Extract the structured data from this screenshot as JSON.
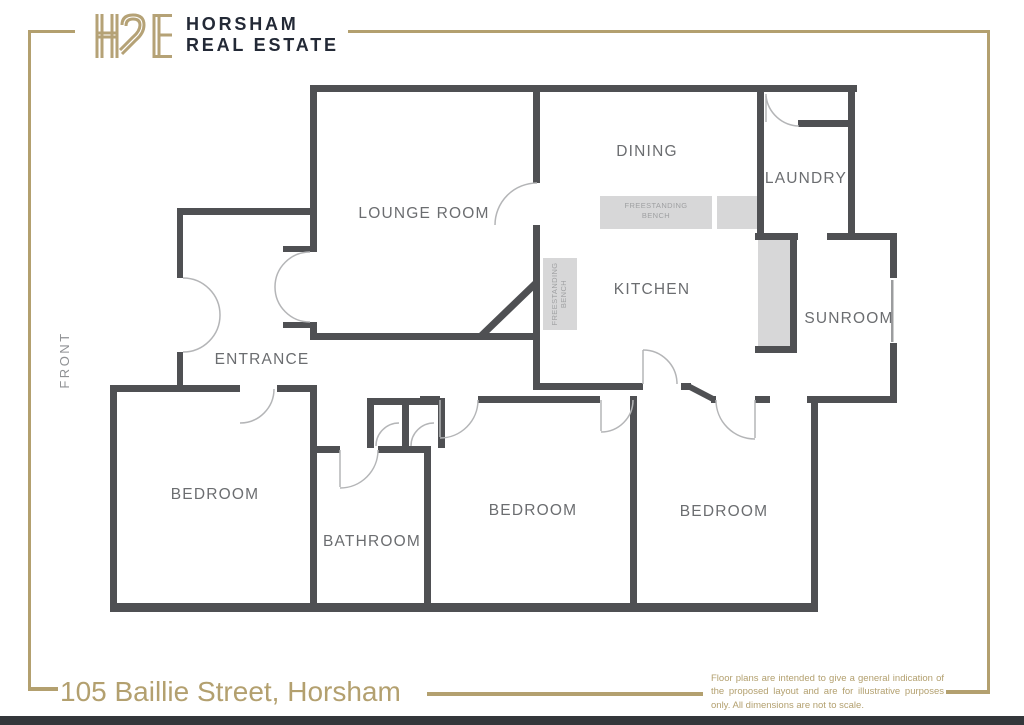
{
  "brand": {
    "monogram": "HRE",
    "name_line1": "HORSHAM",
    "name_line2": "REAL ESTATE"
  },
  "floorplan": {
    "front_label": "FRONT",
    "labels": {
      "lounge": "LOUNGE ROOM",
      "dining": "DINING",
      "laundry": "LAUNDRY",
      "kitchen": "KITCHEN",
      "sunroom": "SUNROOM",
      "entrance": "ENTRANCE",
      "bedroom1": "BEDROOM",
      "bathroom": "BATHROOM",
      "bedroom2": "BEDROOM",
      "bedroom3": "BEDROOM"
    },
    "fixtures": {
      "bench_line1": "FREESTANDING",
      "bench_line2": "BENCH"
    },
    "colors": {
      "wall": "#4f5053",
      "door_arc": "#b4b5b7",
      "bench_fill": "#d7d7d8",
      "room_label": "#6b6d70",
      "gold": "#b3a06f"
    }
  },
  "footer": {
    "address": "105 Baillie Street, Horsham",
    "disclaimer": "Floor plans are intended to give a general indication of the proposed layout and are for illustrative purposes only. All dimensions are not to scale."
  }
}
